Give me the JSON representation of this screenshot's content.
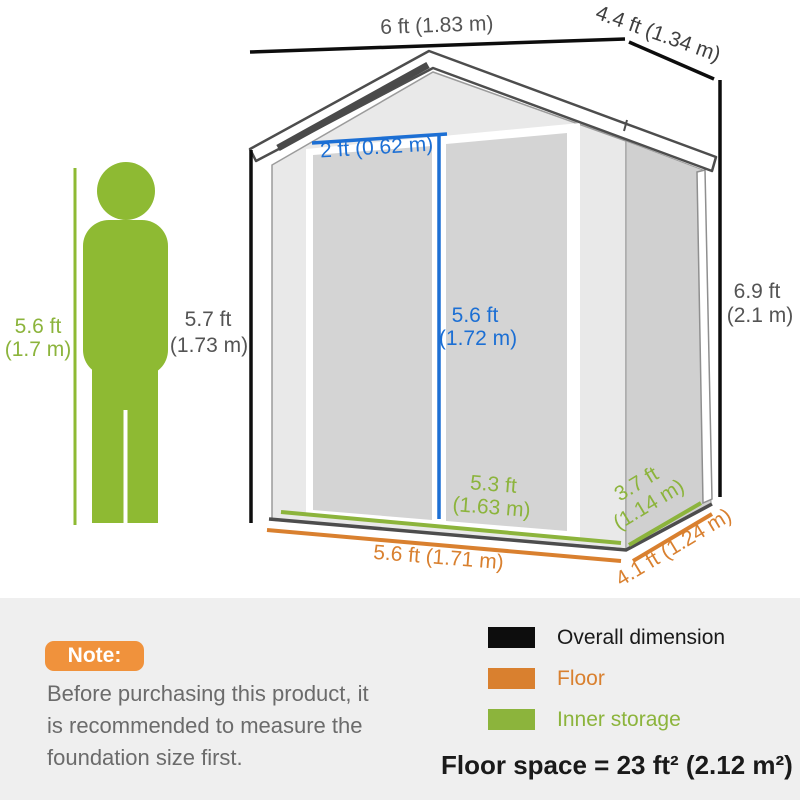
{
  "dims": {
    "overall_width": "6 ft (1.83 m)",
    "overall_depth": "4.4 ft (1.34 m)",
    "overall_height_ft": "6.9 ft",
    "overall_height_m": "(2.1 m)",
    "door_width": "2 ft (0.62 m)",
    "door_height_ft": "5.6 ft",
    "door_height_m": "(1.72 m)",
    "human_height_ft": "5.6 ft",
    "human_height_m": "(1.7 m)",
    "front_height_ft": "5.7 ft",
    "front_height_m": "(1.73 m)",
    "inner_width_ft": "5.3 ft",
    "inner_width_m": "(1.63 m)",
    "inner_depth_ft": "3.7 ft",
    "inner_depth_m": "(1.14 m)",
    "floor_width": "5.6 ft (1.71 m)",
    "floor_depth": "4.1 ft (1.24 m)"
  },
  "note": {
    "badge": "Note:",
    "lines": [
      "Before purchasing this product, it",
      "is recommended to measure the",
      "foundation size first."
    ]
  },
  "legend": {
    "items": [
      {
        "label": "Overall dimension",
        "color": "#0d0d0d"
      },
      {
        "label": "Floor",
        "color": "#d9802f"
      },
      {
        "label": "Inner storage",
        "color": "#8cb43c"
      }
    ]
  },
  "footer": {
    "floor_space": "Floor space = 23 ft² (2.12 m²)"
  },
  "colors": {
    "overall_dimension_black": "#0d0d0d",
    "floor_orange": "#d9802f",
    "inner_storage_green": "#8cb43c",
    "door_dimension_blue": "#1c6fd4",
    "human_figure_green": "#8eba33",
    "label_gray": "#545454",
    "note_badge_orange": "#f0923c"
  }
}
